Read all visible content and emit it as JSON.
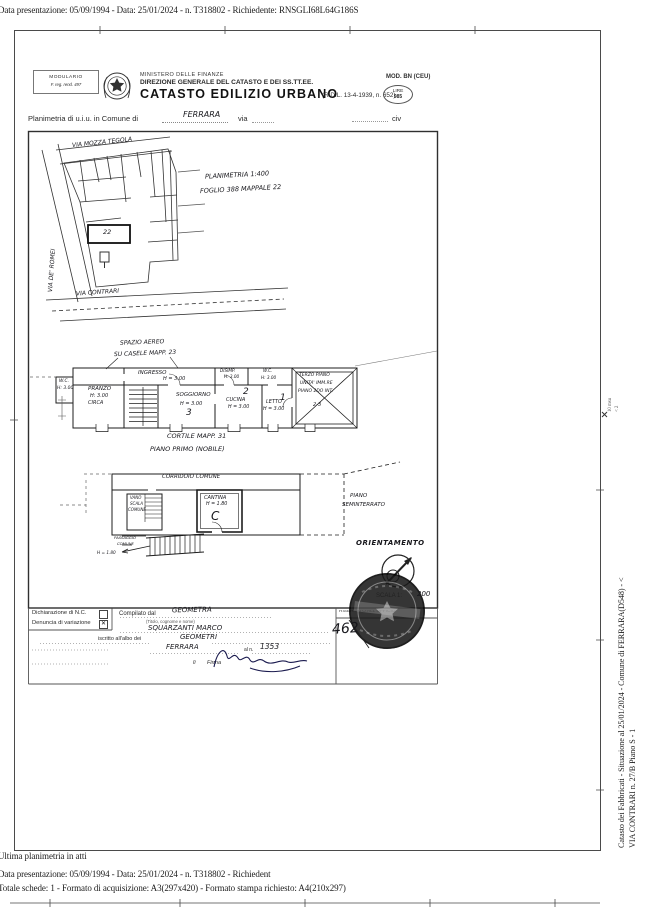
{
  "doc": {
    "top_line": "Data presentazione: 05/09/1994 - Data: 25/01/2024 - n. T318802 - Richiedente: RNSGLI68L64G186S",
    "bottom_line1": "Ultima planimetria in atti",
    "bottom_line2": "Data presentazione: 05/09/1994 - Data: 25/01/2024 - n. T318802 - Richiedent",
    "bottom_line3": "Totale schede: 1 - Formato di acquisizione: A3(297x420)  - Formato stampa richiesto: A4(210x297)",
    "side_line1": "Catasto dei Fabbricati - Situazione al 25/01/2024 - Comune di FERRARA(D548) - <",
    "side_line2": "VIA CONTRARI n. 27/B Piano S - 1",
    "margin_note1": "10 msu",
    "margin_note2": "< 2"
  },
  "header": {
    "modulario_l1": "MODULARIO",
    "modulario_l2": "F. reg. rend. 497",
    "ministry": "MINISTERO DELLE FINANZE",
    "direzione": "DIREZIONE GENERALE DEL CATASTO E DEI SS.TT.EE.",
    "title": "CATASTO EDILIZIO URBANO",
    "title_ref": "(R.D.L. 13-4-1939, n. 652)",
    "mod_code": "MOD. BN (CEU)",
    "lire_l1": "LIRE",
    "lire_l2": "985",
    "plan_label": "Planimetria di u.i.u. in Comune di",
    "comune_value": "FERRARA",
    "via_label": "via",
    "civ_label": "civ"
  },
  "site_map": {
    "street_top": "VIA MOZZA TEGOLA",
    "street_left": "VIA DE' ROMEI",
    "street_bottom": "VIA CONTRARI",
    "note1": "PLANIMETRIA 1:400",
    "note2": "FOGLIO 388 MAPPALE 22",
    "parcel": "22"
  },
  "floor_first": {
    "air_note1": "SPAZIO AEREO",
    "air_note2": "SU CASELE MAPP. 23",
    "wc1_l1": "W.C.",
    "wc1_l2": "H: 3.00",
    "pranzo_l1": "PRANZO",
    "pranzo_l2": "H: 3.00",
    "pranzo_l3": "CIRCA",
    "ingresso_l1": "INGRESSO",
    "ingresso_l2": "H = 3.00",
    "soggiorno_l1": "SOGGIORNO",
    "soggiorno_l2": "H = 3.00",
    "soggiorno_num": "3",
    "disimp_l1": "DISIMP.",
    "disimp_l2": "H: 3.00",
    "wc2_l1": "W.C.",
    "wc2_l2": "H: 3.00",
    "cucina_l1": "CUCINA",
    "cucina_l2": "H = 3.00",
    "cucina_num": "2",
    "letto_l1": "LETTO",
    "letto_l2": "H = 3.00",
    "letto_num": "1",
    "crossed_l1": "TERZO PIANO",
    "crossed_l2": "UNITA' IMM.RE",
    "crossed_l3": "PIANO 2DO INT.",
    "crossed_l4": "2-3",
    "caption1": "CORTILE MAPP. 31",
    "caption2": "PIANO PRIMO (NOBILE)"
  },
  "floor_basement": {
    "corridor": "CORRIDOIO COMUNE",
    "vano_l1": "VANO",
    "vano_l2": "SCALA",
    "vano_l3": "COMUNE",
    "cantina_l1": "CANTINA",
    "cantina_l2": "H = 1.80",
    "cantina_letter": "C",
    "piano_l1": "PIANO",
    "piano_l2": "SEMINTERRATO",
    "pass_l1": "PASSAGGIO",
    "pass_l2": "COMUNE",
    "pass_l3": "H = 1.80"
  },
  "orientation_label": "ORIENTAMENTO",
  "scale_label": "SCALA 1:",
  "scale_value": "200",
  "reference_number": "462",
  "form": {
    "decl_label": "Dichiarazione di N.C.",
    "var_label": "Denuncia di  variazione",
    "var_mark": "✕",
    "compilato_label": "Compilato dal",
    "compilato_value": "GEOMETRA",
    "titolo_hint": "(Titolo, cognome e nome)",
    "name_value": "SQUARZANTI  MARCO",
    "albo_label": "iscritto all'albo dei",
    "albo_value": "GEOMETRI",
    "al_n_label": "al n.",
    "place_value": "FERRARA",
    "number_value": "1353",
    "li_label": "lì",
    "firma_label": "Firma",
    "reserved_label": "RISERVATO ALL'UFFICIO"
  }
}
